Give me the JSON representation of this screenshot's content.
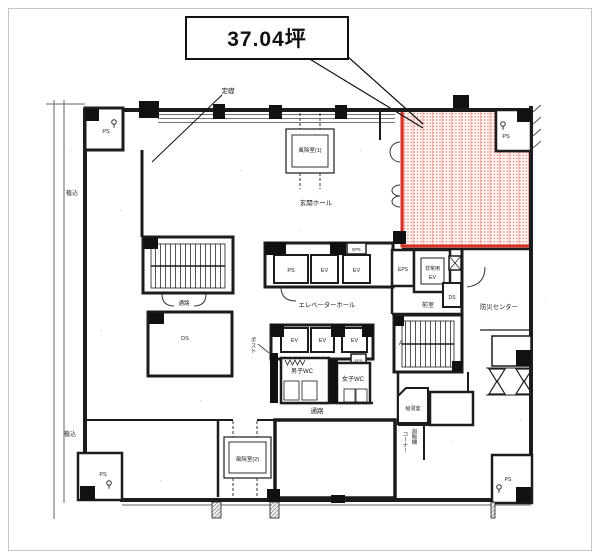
{
  "callout": {
    "area": "37.04坪"
  },
  "plan": {
    "cornerstone": "定礎",
    "windbreak_1": "風除室(1)",
    "entrance_hall": "玄関ホール",
    "elevator_hall": "エレベーターホール",
    "emergency_ev_line1": "非常用",
    "emergency_ev_line2": "EV",
    "anteroom": "前室",
    "disaster_center": "防災センター",
    "mens_wc": "男子WC",
    "womens_wc": "女子WC",
    "passage": "通路",
    "windbreak_2": "風除室(2)",
    "kitchenette": "給湯室",
    "vending_col_right": "自販機",
    "vending_col_left": "コーナー",
    "planting": "植込",
    "mail_chute": "ポスト",
    "stair_label": "A",
    "ps": "PS",
    "ev": "EV",
    "eps": "EPS",
    "ds": "DS"
  },
  "colors": {
    "highlight_border": "#d93025",
    "highlight_dot": "#dd5a50",
    "wall": "#1c1c1c"
  }
}
